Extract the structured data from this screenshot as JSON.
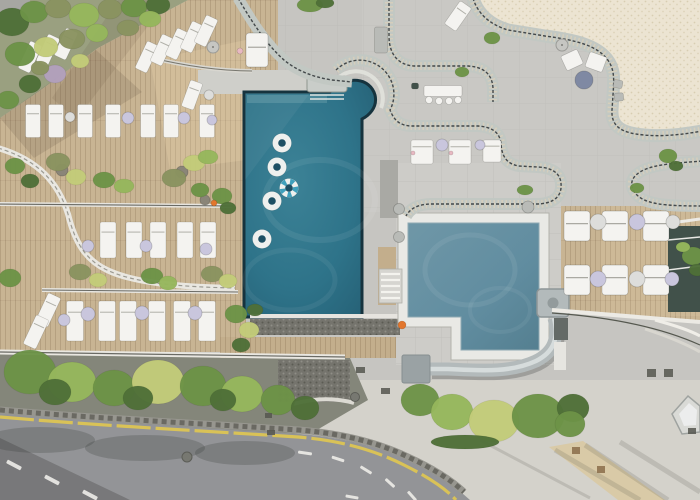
{
  "meta": {
    "scene": "aerial-drone-view-hotel-pool-terrace"
  },
  "palette": {
    "concrete": "#c6c5c1",
    "concreteLight": "#d8d5cd",
    "terrace": "#c9c8c4",
    "tilePale": "#cdccc8",
    "wood": "#c8b493",
    "woodStrip": "#c3ae8c",
    "poolRim": "#16333e",
    "poolDeep": "#1d4f63",
    "kidsRim": "#8fa9b2",
    "tileWhite": "#e9e9e5",
    "band": "#c2c8c3",
    "bandLine": "#43484a",
    "bandSlat": "#d9d0bb",
    "cream": "#ece4d2",
    "creamDot": "#d6cab0",
    "road": "#939497",
    "roadDark": "#7e7f83",
    "yellow": "#d9c257",
    "laneWhite": "#eceae6",
    "curbWall": "#97968f",
    "curbDark": "#5f5e56",
    "furnitureWhite": "#f4f3f0",
    "tableWhite": "#dddddb",
    "lavender": "#c9c6dd",
    "grayTable": "#7f89a3",
    "steel": "#b9bbb7",
    "slide": "#b3babb",
    "slideHi": "#d6dcdc",
    "slideEnd": "#9aa2a4",
    "treeDark": "#4f7038",
    "tree": "#6d9347",
    "treeLight": "#96b75c",
    "treeYellow": "#c3cc79",
    "olive": "#8a9360",
    "lilac": "#b2a0bd",
    "groundShade": "#84867a",
    "gravel": "#75746d",
    "glass": "#41514a",
    "orange": "#e2762d",
    "pink": "#e8b9c2",
    "tan": "#d9c9a4",
    "garden": "#9aa080",
    "stripe": "#3fa0bc"
  },
  "pools": {
    "main": {
      "shape": "rectangular",
      "floats_white": 4,
      "floats_striped": 1
    },
    "kids": {
      "shape": "l-shaped",
      "has_slide": true,
      "orange_buoys": 1
    }
  },
  "pool_floats": [
    {
      "x": 282,
      "y": 143
    },
    {
      "x": 277,
      "y": 167
    },
    {
      "x": 289,
      "y": 188,
      "striped": true
    },
    {
      "x": 272,
      "y": 201
    },
    {
      "x": 262,
      "y": 239
    }
  ],
  "furniture": {
    "sun_loungers": [
      {
        "x": 147,
        "y": 57,
        "rot": 25,
        "w": 13,
        "h": 30
      },
      {
        "x": 162,
        "y": 50,
        "rot": 25,
        "w": 13,
        "h": 30
      },
      {
        "x": 177,
        "y": 44,
        "rot": 25,
        "w": 13,
        "h": 30
      },
      {
        "x": 192,
        "y": 37,
        "rot": 25,
        "w": 13,
        "h": 30
      },
      {
        "x": 206,
        "y": 31,
        "rot": 25,
        "w": 13,
        "h": 30
      },
      {
        "x": 30,
        "y": 57,
        "rot": 25,
        "w": 13,
        "h": 30
      },
      {
        "x": 48,
        "y": 50,
        "rot": 25,
        "w": 13,
        "h": 30
      },
      {
        "x": 66,
        "y": 44,
        "rot": 25,
        "w": 13,
        "h": 30
      },
      {
        "x": 192,
        "y": 95,
        "rot": 20,
        "w": 13,
        "h": 28
      },
      {
        "x": 33,
        "y": 121
      },
      {
        "x": 56,
        "y": 121
      },
      {
        "x": 85,
        "y": 121
      },
      {
        "x": 113,
        "y": 121
      },
      {
        "x": 148,
        "y": 121
      },
      {
        "x": 171,
        "y": 121
      },
      {
        "x": 207,
        "y": 121
      },
      {
        "x": 108,
        "y": 240,
        "w": 16,
        "h": 36
      },
      {
        "x": 134,
        "y": 240,
        "w": 16,
        "h": 36
      },
      {
        "x": 158,
        "y": 240,
        "w": 16,
        "h": 36
      },
      {
        "x": 185,
        "y": 240,
        "w": 16,
        "h": 36
      },
      {
        "x": 208,
        "y": 240,
        "w": 16,
        "h": 36
      },
      {
        "x": 75,
        "y": 321,
        "w": 17,
        "h": 40
      },
      {
        "x": 107,
        "y": 321,
        "w": 17,
        "h": 40
      },
      {
        "x": 128,
        "y": 321,
        "w": 17,
        "h": 40
      },
      {
        "x": 157,
        "y": 321,
        "w": 17,
        "h": 40
      },
      {
        "x": 182,
        "y": 321,
        "w": 17,
        "h": 40
      },
      {
        "x": 207,
        "y": 321,
        "w": 17,
        "h": 40
      },
      {
        "x": 48,
        "y": 310,
        "rot": 25,
        "w": 14,
        "h": 32
      },
      {
        "x": 36,
        "y": 332,
        "rot": 25,
        "w": 14,
        "h": 32
      },
      {
        "x": 458,
        "y": 16,
        "rot": 35,
        "w": 14,
        "h": 28
      },
      {
        "x": 422,
        "y": 152,
        "w": 22,
        "h": 24
      },
      {
        "x": 460,
        "y": 152,
        "w": 22,
        "h": 24
      },
      {
        "x": 492,
        "y": 151,
        "w": 18,
        "h": 22
      }
    ],
    "daybeds": [
      {
        "x": 577,
        "y": 226
      },
      {
        "x": 615,
        "y": 226
      },
      {
        "x": 656,
        "y": 226
      },
      {
        "x": 577,
        "y": 280
      },
      {
        "x": 615,
        "y": 280
      },
      {
        "x": 656,
        "y": 280
      },
      {
        "x": 257,
        "y": 50,
        "w": 22,
        "h": 34
      }
    ],
    "side_tables": [
      {
        "x": 70,
        "y": 117,
        "r": 5,
        "c": "tableWhite"
      },
      {
        "x": 128,
        "y": 118,
        "r": 6,
        "c": "lavender"
      },
      {
        "x": 184,
        "y": 118,
        "r": 6,
        "c": "lavender"
      },
      {
        "x": 212,
        "y": 120,
        "r": 5,
        "c": "lavender"
      },
      {
        "x": 88,
        "y": 246,
        "r": 6,
        "c": "lavender"
      },
      {
        "x": 146,
        "y": 246,
        "r": 6,
        "c": "lavender"
      },
      {
        "x": 206,
        "y": 249,
        "r": 6,
        "c": "lavender"
      },
      {
        "x": 88,
        "y": 314,
        "r": 7,
        "c": "lavender"
      },
      {
        "x": 142,
        "y": 313,
        "r": 7,
        "c": "lavender"
      },
      {
        "x": 195,
        "y": 313,
        "r": 7,
        "c": "lavender"
      },
      {
        "x": 64,
        "y": 320,
        "r": 6,
        "c": "lavender"
      },
      {
        "x": 442,
        "y": 145,
        "r": 6,
        "c": "lavender"
      },
      {
        "x": 480,
        "y": 145,
        "r": 5,
        "c": "lavender"
      },
      {
        "x": 598,
        "y": 222,
        "r": 8,
        "c": "tableWhite"
      },
      {
        "x": 637,
        "y": 222,
        "r": 8,
        "c": "lavender"
      },
      {
        "x": 673,
        "y": 222,
        "r": 7,
        "c": "tableWhite"
      },
      {
        "x": 598,
        "y": 279,
        "r": 8,
        "c": "lavender"
      },
      {
        "x": 637,
        "y": 279,
        "r": 8,
        "c": "tableWhite"
      },
      {
        "x": 672,
        "y": 279,
        "r": 7,
        "c": "lavender"
      },
      {
        "x": 584,
        "y": 80,
        "r": 9,
        "c": "grayTable"
      },
      {
        "x": 209,
        "y": 95,
        "r": 5,
        "c": "tableWhite"
      }
    ],
    "umbrellas": [
      {
        "x": 213,
        "y": 47,
        "r": 6
      },
      {
        "x": 562,
        "y": 45,
        "r": 6
      }
    ],
    "chairs": [
      {
        "x": 572,
        "y": 60,
        "w": 18,
        "h": 16,
        "rot": -25
      },
      {
        "x": 596,
        "y": 62,
        "w": 18,
        "h": 16,
        "rot": 20
      },
      {
        "x": 618,
        "y": 84,
        "w": 9,
        "h": 8,
        "rot": 10,
        "c": "steel"
      },
      {
        "x": 619,
        "y": 97,
        "w": 9,
        "h": 8,
        "rot": -5,
        "c": "steel"
      },
      {
        "x": 415,
        "y": 86,
        "w": 7,
        "h": 6,
        "rot": 0,
        "c": "glass"
      }
    ],
    "round_chairs": [
      {
        "x": 429,
        "y": 100
      },
      {
        "x": 439,
        "y": 101
      },
      {
        "x": 449,
        "y": 101
      },
      {
        "x": 458,
        "y": 100
      }
    ],
    "benches": [
      {
        "x": 381,
        "y": 40,
        "w": 13,
        "h": 26,
        "c": "steel"
      },
      {
        "x": 443,
        "y": 91,
        "w": 38,
        "h": 11,
        "c": "furnitureWhite"
      }
    ]
  },
  "pots": [
    {
      "x": 399,
      "y": 209,
      "r": 5.5,
      "c": "steel"
    },
    {
      "x": 528,
      "y": 207,
      "r": 6,
      "c": "steel"
    },
    {
      "x": 399,
      "y": 237,
      "r": 5.5,
      "c": "steel"
    },
    {
      "x": 62,
      "y": 170,
      "r": 6,
      "c": "#8a8578"
    },
    {
      "x": 182,
      "y": 172,
      "r": 6,
      "c": "#8a8578"
    },
    {
      "x": 205,
      "y": 200,
      "r": 5,
      "c": "#8a8578"
    }
  ],
  "vegetation": [
    [
      30,
      372,
      26,
      22,
      "tree"
    ],
    [
      72,
      382,
      24,
      20,
      "treeLight"
    ],
    [
      114,
      388,
      21,
      18,
      "tree"
    ],
    [
      158,
      382,
      26,
      22,
      "treeYellow"
    ],
    [
      203,
      386,
      23,
      20,
      "tree"
    ],
    [
      242,
      394,
      21,
      18,
      "treeLight"
    ],
    [
      278,
      400,
      17,
      15,
      "tree"
    ],
    [
      55,
      392,
      16,
      13,
      "treeDark"
    ],
    [
      138,
      398,
      15,
      12,
      "treeDark"
    ],
    [
      223,
      400,
      13,
      11,
      "treeDark"
    ],
    [
      305,
      408,
      14,
      12,
      "treeDark"
    ],
    [
      420,
      400,
      19,
      16,
      "tree"
    ],
    [
      452,
      412,
      21,
      18,
      "treeLight"
    ],
    [
      494,
      421,
      25,
      21,
      "treeYellow"
    ],
    [
      538,
      416,
      26,
      22,
      "tree"
    ],
    [
      573,
      408,
      16,
      14,
      "treeDark"
    ],
    [
      570,
      424,
      15,
      13,
      "tree"
    ],
    [
      465,
      442,
      34,
      7,
      "treeDark"
    ],
    [
      12,
      22,
      17,
      14,
      "treeDark"
    ],
    [
      34,
      12,
      14,
      11,
      "tree"
    ],
    [
      58,
      8,
      13,
      10,
      "olive"
    ],
    [
      84,
      15,
      15,
      12,
      "treeLight"
    ],
    [
      110,
      9,
      12,
      10,
      "olive"
    ],
    [
      134,
      7,
      13,
      10,
      "tree"
    ],
    [
      158,
      5,
      12,
      9,
      "treeDark"
    ],
    [
      20,
      54,
      15,
      12,
      "tree"
    ],
    [
      46,
      47,
      12,
      10,
      "treeYellow"
    ],
    [
      72,
      39,
      13,
      10,
      "olive"
    ],
    [
      97,
      33,
      11,
      9,
      "treeLight"
    ],
    [
      55,
      74,
      11,
      9,
      "lilac"
    ],
    [
      30,
      84,
      11,
      9,
      "treeDark"
    ],
    [
      80,
      61,
      9,
      7,
      "treeYellow"
    ],
    [
      128,
      28,
      11,
      8,
      "olive"
    ],
    [
      150,
      19,
      11,
      8,
      "treeLight"
    ],
    [
      8,
      100,
      11,
      9,
      "tree"
    ],
    [
      40,
      68,
      9,
      7,
      "olive"
    ],
    [
      58,
      162,
      12,
      9,
      "olive"
    ],
    [
      76,
      177,
      10,
      8,
      "treeYellow"
    ],
    [
      104,
      180,
      11,
      8,
      "tree"
    ],
    [
      124,
      186,
      10,
      7,
      "treeLight"
    ],
    [
      174,
      178,
      12,
      9,
      "olive"
    ],
    [
      194,
      163,
      11,
      8,
      "treeYellow"
    ],
    [
      208,
      157,
      10,
      7,
      "treeLight"
    ],
    [
      200,
      190,
      9,
      7,
      "tree"
    ],
    [
      15,
      166,
      10,
      8,
      "tree"
    ],
    [
      30,
      181,
      9,
      7,
      "treeDark"
    ],
    [
      10,
      278,
      11,
      9,
      "tree"
    ],
    [
      80,
      272,
      11,
      8,
      "olive"
    ],
    [
      98,
      280,
      9,
      7,
      "treeYellow"
    ],
    [
      152,
      276,
      11,
      8,
      "tree"
    ],
    [
      168,
      283,
      9,
      7,
      "treeLight"
    ],
    [
      212,
      274,
      11,
      8,
      "olive"
    ],
    [
      228,
      281,
      9,
      7,
      "treeYellow"
    ],
    [
      236,
      314,
      11,
      9,
      "tree"
    ],
    [
      249,
      330,
      10,
      8,
      "treeYellow"
    ],
    [
      241,
      345,
      9,
      7,
      "treeDark"
    ],
    [
      255,
      310,
      8,
      6,
      "treeDark"
    ],
    [
      222,
      196,
      10,
      8,
      "tree"
    ],
    [
      228,
      208,
      8,
      6,
      "treeDark"
    ],
    [
      668,
      156,
      9,
      7,
      "tree"
    ],
    [
      676,
      166,
      7,
      5,
      "treeDark"
    ],
    [
      637,
      188,
      7,
      5,
      "tree"
    ],
    [
      525,
      190,
      8,
      5,
      "tree"
    ],
    [
      693,
      256,
      11,
      9,
      "tree"
    ],
    [
      697,
      270,
      8,
      6,
      "treeDark"
    ],
    [
      683,
      247,
      7,
      5,
      "treeLight"
    ],
    [
      310,
      5,
      13,
      7,
      "tree"
    ],
    [
      325,
      3,
      9,
      5,
      "treeDark"
    ],
    [
      462,
      72,
      7,
      5,
      "tree"
    ],
    [
      492,
      38,
      8,
      6,
      "tree"
    ]
  ],
  "road": {
    "dashes": [
      [
        14,
        465,
        16,
        4,
        28
      ],
      [
        52,
        480,
        16,
        4,
        28
      ],
      [
        90,
        495,
        16,
        4,
        28
      ],
      [
        305,
        453,
        14,
        3,
        8
      ],
      [
        338,
        459,
        13,
        3,
        18
      ],
      [
        366,
        470,
        13,
        3,
        32
      ],
      [
        390,
        483,
        12,
        3,
        42
      ],
      [
        412,
        496,
        12,
        3,
        48
      ],
      [
        352,
        497,
        13,
        3,
        10
      ]
    ],
    "manholes": [
      [
        187,
        457,
        5
      ],
      [
        355,
        397,
        4.5
      ]
    ],
    "joints": [
      [
        265,
        413,
        7,
        5,
        ""
      ],
      [
        267,
        430,
        8,
        5,
        ""
      ],
      [
        381,
        388,
        9,
        6,
        ""
      ],
      [
        356,
        367,
        9,
        6,
        ""
      ],
      [
        647,
        369,
        9,
        8,
        ""
      ],
      [
        664,
        369,
        9,
        8,
        ""
      ],
      [
        572,
        447,
        8,
        7,
        "#8a6d4a"
      ],
      [
        597,
        466,
        8,
        7,
        "#8a6d4a"
      ],
      [
        688,
        428,
        8,
        6,
        ""
      ]
    ]
  },
  "accents": [
    {
      "x": 214,
      "y": 203,
      "r": 3,
      "c": "orange",
      "name": "towel-orange"
    },
    {
      "x": 402,
      "y": 325,
      "r": 4,
      "c": "orange",
      "name": "pool-buoy"
    },
    {
      "x": 240,
      "y": 51,
      "r": 3,
      "c": "pink",
      "name": "towel-pink"
    },
    {
      "x": 413,
      "y": 153,
      "r": 2,
      "c": "pink",
      "name": "towel-pink"
    },
    {
      "x": 451,
      "y": 153,
      "r": 2,
      "c": "pink",
      "name": "towel-pink"
    }
  ]
}
